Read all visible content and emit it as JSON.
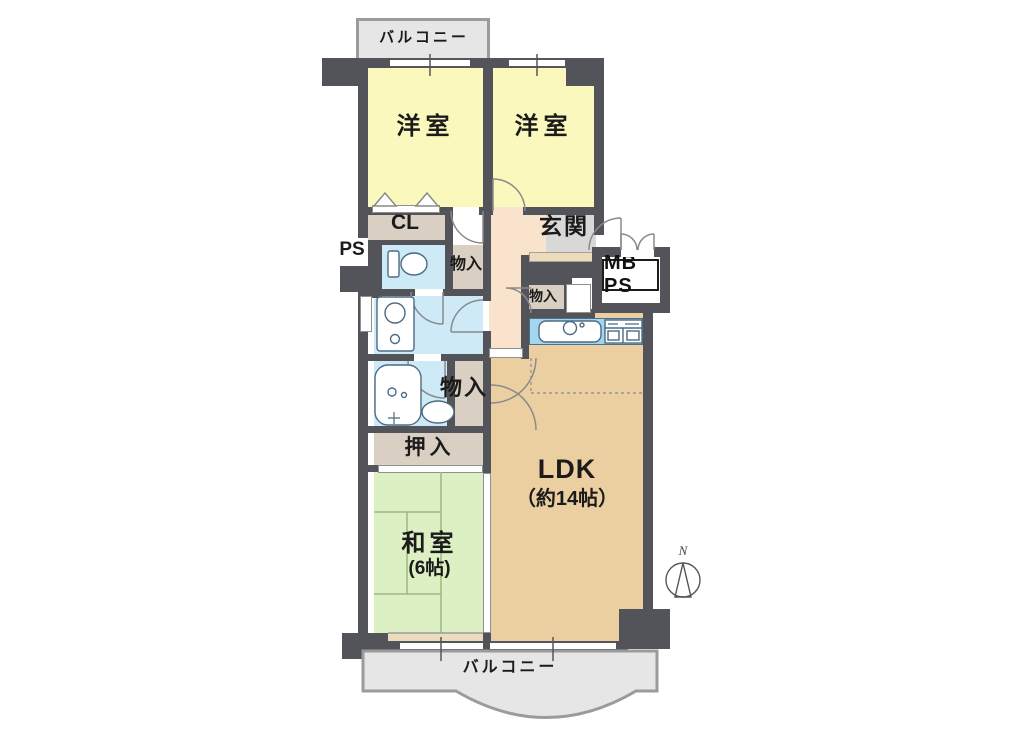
{
  "floor_plan": {
    "labels": {
      "balcony_top": "バルコニー",
      "western_room_left": "洋室",
      "western_room_right": "洋室",
      "closet": "CL",
      "pipe_space": "PS",
      "entrance": "玄関",
      "meter_box": "MB PS",
      "storage_top": "物入",
      "storage_mid": "物入",
      "storage_lower": "物入",
      "oshiire": "押入",
      "japanese_room": "和室",
      "japanese_room_size": "(6帖)",
      "ldk": "LDK",
      "ldk_size": "（約14帖）",
      "balcony_bottom": "バルコニー",
      "compass_north": "N"
    },
    "colors": {
      "wall": "#53535a",
      "western-room": "#faf8bc",
      "japanese-room": "#dcf0c3",
      "ldk": "#eccfa1",
      "corridor": "#f9e3cd",
      "entrance-tile": "#d8d8d8",
      "step": "#ecdcbe",
      "closet": "#d9cfc2",
      "water": "#cdeaf6",
      "kitchen-counter": "#a5d6f0",
      "balcony": "#e6e6e6",
      "fixture-line": "#4c6b84",
      "text": "#1b1b1b"
    }
  }
}
